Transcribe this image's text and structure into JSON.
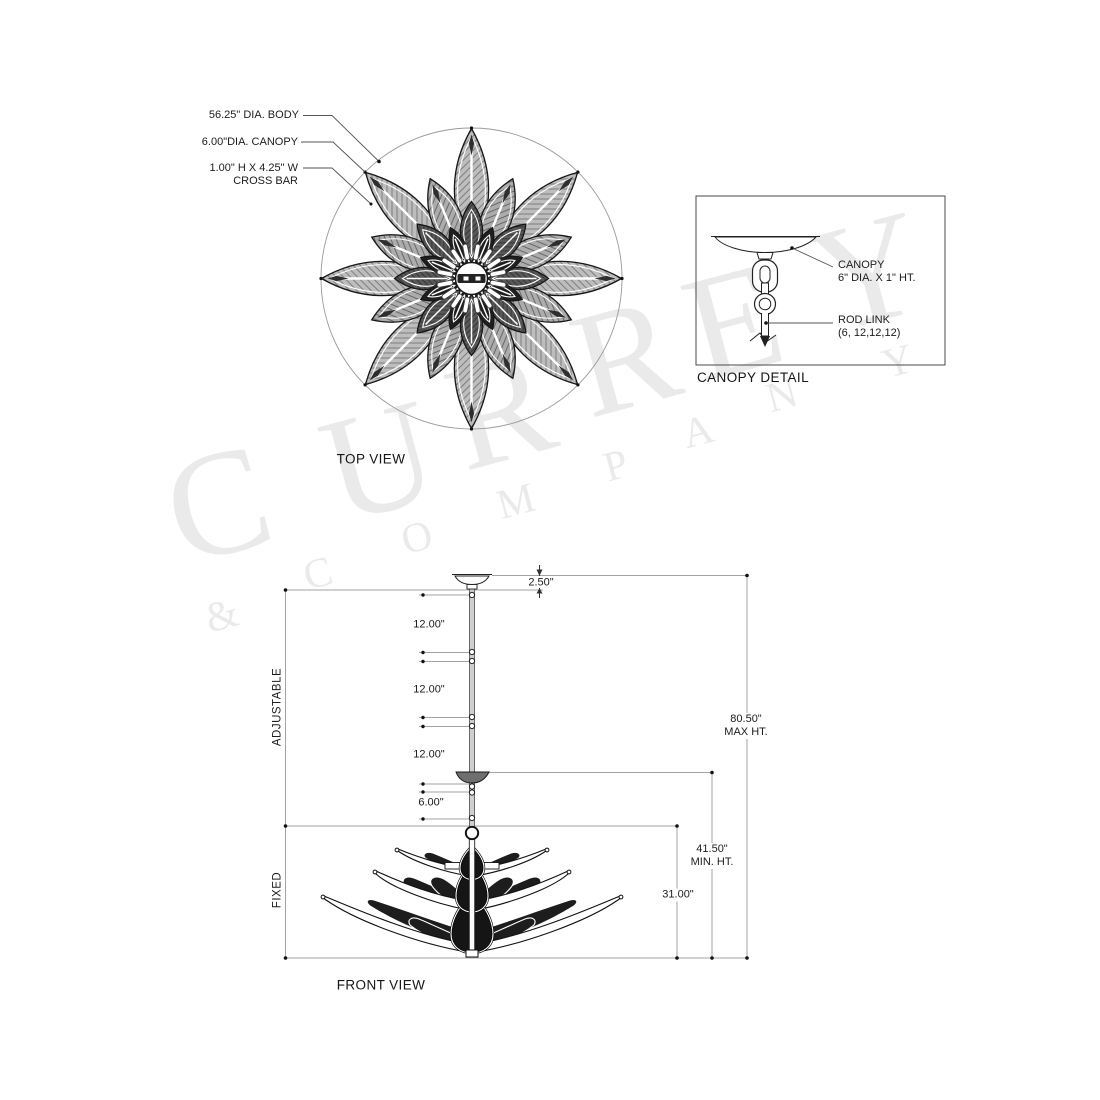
{
  "watermark": {
    "line1": "CURREY",
    "line2": "& COMPANY"
  },
  "top_view": {
    "title": "TOP VIEW",
    "callouts": [
      {
        "label": "56.25\" DIA. BODY"
      },
      {
        "label": "6.00\"DIA. CANOPY"
      },
      {
        "label": "1.00\" H X 4.25\" W",
        "label2": "CROSS BAR"
      }
    ]
  },
  "canopy_detail": {
    "title": "CANOPY DETAIL",
    "canopy_label": "CANOPY",
    "canopy_size": "6\" DIA. X 1\" HT.",
    "rod_link_label": "ROD LINK",
    "rod_link_values": "(6, 12,12,12)"
  },
  "front_view": {
    "title": "FRONT VIEW",
    "canopy_drop": "2.50\"",
    "segments": [
      "12.00\"",
      "12.00\"",
      "12.00\"",
      "6.00\""
    ],
    "adjustable_label": "ADJUSTABLE",
    "fixed_label": "FIXED",
    "max_height": "80.50\"",
    "max_height_label": "MAX HT.",
    "min_height": "41.50\"",
    "min_height_label": "MIN. HT.",
    "fixed_height": "31.00\""
  },
  "colors": {
    "line": "#1a1a1a",
    "dim_line": "#a3a3a3",
    "watermark": "#eaeaea",
    "leaf_dark": "#1d1d1d",
    "leaf_hatch": "#9a9a9a"
  }
}
